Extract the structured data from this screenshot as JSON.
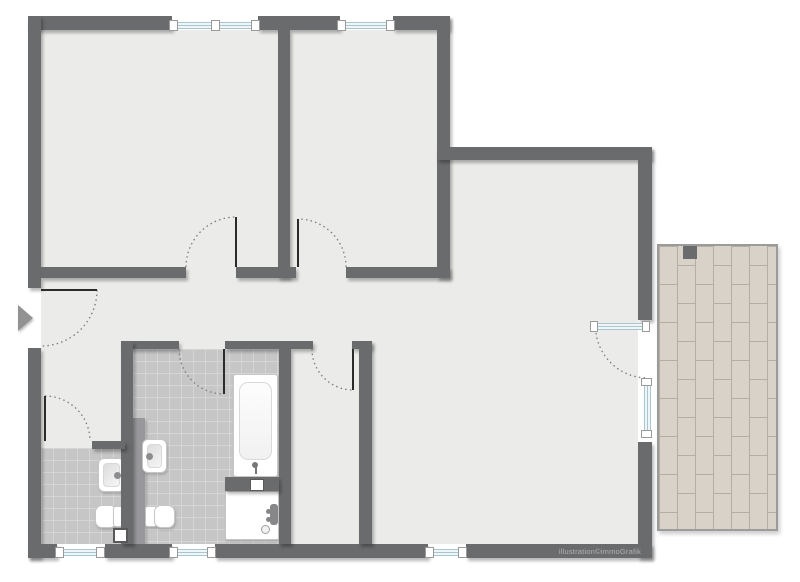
{
  "watermark": {
    "text": "illustration©immoGrafik"
  },
  "entrance": {
    "icon": "entry-direction-arrow-right"
  },
  "symbols": {
    "fixtures": [
      "bathtub",
      "shower-tray",
      "washbasin-wc",
      "washbasin-bath",
      "toilet-wc",
      "toilet-bath",
      "service-shaft",
      "terrace-decking"
    ],
    "doors": [
      "entry-door",
      "room-1-door",
      "room-2-door",
      "wc-door",
      "bathroom-door",
      "storage-door",
      "terrace-glass-door"
    ],
    "windows": [
      "top-window-left",
      "top-window-right",
      "wc-window",
      "bathroom-window",
      "living-bottom-window",
      "living-terrace-window"
    ]
  },
  "colors": {
    "wall": "#6a6b6d",
    "floor": "#ebece9",
    "outside": "#ffffff",
    "tile": "#c6c6c7",
    "tile-grout": "#d5d5d5",
    "prewall": "#98989c",
    "glass-line": "#a9c5cd",
    "glass-bg": "#f0f6f7",
    "cap-border": "#9a9a9a",
    "fixture-border": "#c6c6c6",
    "door-leaf": "#2b2b2b",
    "arc": "#7a7a7a",
    "plank": "#d8d2c8",
    "plank-joint": "#b5ada1",
    "terrace-border": "#9b9b9b",
    "arrow": "#929292",
    "watermark-text": "#b2b2b2"
  }
}
